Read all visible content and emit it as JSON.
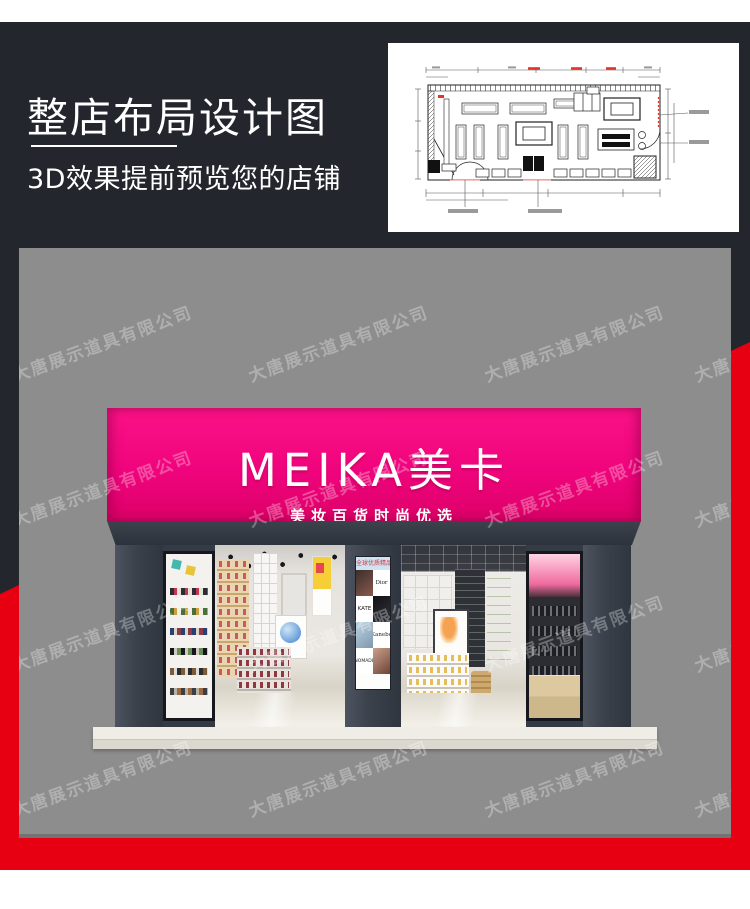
{
  "header": {
    "title": "整店布局设计图",
    "subtitle": "3D效果提前预览您的店铺"
  },
  "watermark": {
    "text": "大唐展示道具有限公司"
  },
  "storefront": {
    "sign_title": "MEIKA美卡",
    "sign_subtitle": "美妆百货时尚优选",
    "poster": {
      "header": "全球优质精品",
      "brands": [
        "Dior",
        "KATE",
        "Kanebo",
        "NOMADE"
      ]
    }
  },
  "colors": {
    "charcoal": "#23262d",
    "accent_red": "#e60012",
    "sign_pink": "#f0047d",
    "photo_gray": "#8d8d8d",
    "plan_paper": "#ffffff"
  }
}
